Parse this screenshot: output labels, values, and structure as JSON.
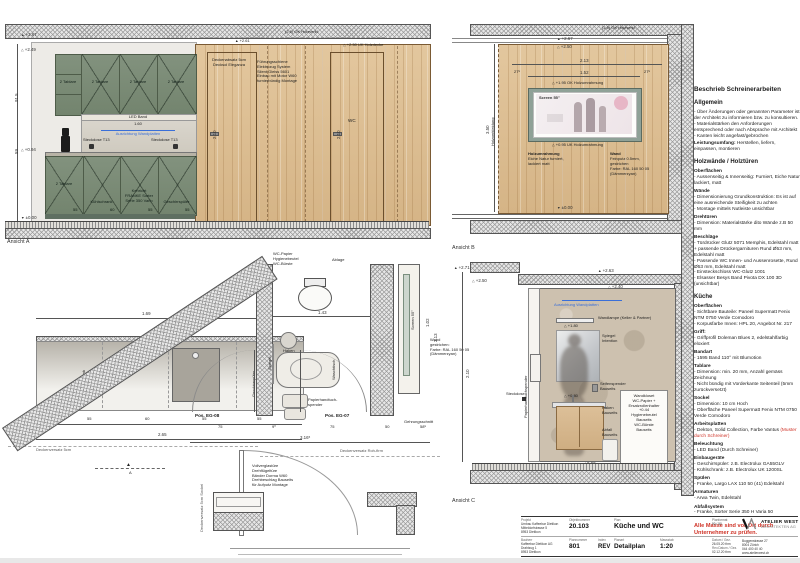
{
  "a": {
    "title": "Ansicht A",
    "lv267": "+2.67",
    "lv249": "+2.49",
    "lv094": "+0.94",
    "lv000": "±0.00",
    "d915": "91.5",
    "d59": "59",
    "d160": "1.60",
    "d210": "2.10",
    "okholz": "(2.6) OK Holzverkl.",
    "lv261": "+2.61",
    "ukholz": "+2.50 UK Holzdecke",
    "decken1": "Deckenabsatz 5cm",
    "decken2": "Decksol Eleganza",
    "doornote": [
      "Führungsschiene",
      "Elektrozug System",
      "Silent Gleiss 5601",
      "Einbau mit Motor W60",
      "furnierbündig Montage"
    ],
    "led": "LED Band",
    "ausr": "Ausrichtung Wandplatten",
    "steck": "Steckdose T13",
    "tab": "2 Tablare",
    "kuehl": "Kühlschrank",
    "keh1": "Kehricht",
    "keh2": "FRANKE Sorter",
    "keh3": "Serie 350 Vario",
    "gesch": "Geschirrspüler",
    "wc": "WC",
    "n55": "55",
    "n60": "60"
  },
  "b": {
    "title": "Ansicht B",
    "screen": "Screen 55\"",
    "lv267": "+2.67",
    "lv250": "+2.50",
    "d213": "2.13",
    "d152": "1.52",
    "d275": "27⁵",
    "okum": "+1.95 OK Holzumrahmung",
    "ukum": "+0.95 UK Holzumrahmung",
    "okholz": "(2.6) OK Holzverkl.",
    "lv000": "±0.00",
    "d350": "3.50",
    "holzverkl": "Holzverkleidung",
    "um1": "Holzumrahmung",
    "um2": "Eiche Natur furniert,",
    "um3": "lackiert matt",
    "wand1": "Wand",
    "wand2": "Feinputz 0.5mm,",
    "wand3": "gestrichen",
    "wand4": "Farbe: RAL 160 50 05",
    "wand5": "(Dämmerzyan)"
  },
  "p": {
    "d169": "1.69",
    "d265": "2.65",
    "d316": "3.16⁵",
    "d211": "2.11",
    "segs": [
      "27",
      "55",
      "60",
      "55",
      "55"
    ],
    "s75a": "75",
    "s90": "9⁰",
    "s75b": "75",
    "s50": "50",
    "s585": "58⁵",
    "kuehl": "Kühlschrank",
    "gesch": "Geschirrspüler",
    "eg08": "Pos. EG-08",
    "eg07": "Pos. EG-07",
    "wcnote": [
      "WC-Papier",
      "Hygienebeutel",
      "WC-Bürste"
    ],
    "ablage": "Ablage",
    "d143": "1.43",
    "haken": "Haken",
    "spiegel": "Spiegel",
    "wasch": "Waschtisch",
    "paph1": "Papierhandtuch-",
    "paph2": "spender",
    "glass": [
      "Vollverglastüre",
      "Drehflügeltüre",
      "Bänder Dorma W60",
      "Drehbeschlag Bauseits",
      "für Aufputz Montage"
    ],
    "deckv": "Deckenversatz 5cm",
    "deckv2": "Deckenversatz Roh-firm",
    "deckv3": "Deckenversatz 5cm Sockel",
    "secA": "A",
    "screen": "Screen 55\"",
    "d102": "1.02",
    "d213": "2.13",
    "wand": [
      "Wand",
      "gestrichen:",
      "Farbe: RAL 160 50 05",
      "(Dämmerzyan)"
    ],
    "gehrung": "Gehrungsschnitt"
  },
  "c": {
    "title": "Ansicht C",
    "lv271": "+2.71",
    "lv250": "+2.50",
    "lv263": "+2.63",
    "lv240": "+2.40",
    "lv180": "+1.80",
    "lv080": "+0.80",
    "lv000": "±0.00",
    "d210": "2.10",
    "ausr": "Ausrichtung Wandplatten",
    "lampe": "Wandlampe (Keller & Partner)",
    "spiegel1": "Spiegel",
    "spiegel2": "Intention",
    "seife1": "Seifenspender",
    "seife2": "Bauseits",
    "steck": "Steckdose",
    "haken1": "Haken",
    "haken2": "Bauseits",
    "abfall1": "Abfall",
    "abfall2": "Bauseits",
    "paph": "Papierhandtuchspender",
    "kloset": [
      "Wandkloset",
      "WC-Papier +",
      "Ersatzrollenhalter",
      "+0.44",
      "Hygienebeutel",
      "Bauseits",
      "WC-Bürste",
      "Bauseits"
    ]
  },
  "besch": {
    "title": "Beschrieb Schreinerarbeiten",
    "blocks": [
      {
        "t": "h2",
        "x": "Allgemein"
      },
      {
        "t": "p",
        "x": "- Über Änderungen oder genannten Parameter ist der Architekt zu informieren bzw. zu konsultieren."
      },
      {
        "t": "p",
        "x": "- Materialstärken den Anforderungen entsprechend oder nach Absprache mit Architekt"
      },
      {
        "t": "p",
        "x": "- Kanten leicht angefast/gebrochen"
      },
      {
        "t": "pb",
        "b": "Leistungsumfang:",
        "x": " Herstellen, liefern, einpassen, montieren"
      },
      {
        "t": "h2",
        "x": "Holzwände / Holztüren"
      },
      {
        "t": "b",
        "x": "Oberflächen"
      },
      {
        "t": "p",
        "x": "- Aussenseitig & Innenseitig: Furniert, Eiche Natur lackiert, matt"
      },
      {
        "t": "b",
        "x": "Wände"
      },
      {
        "t": "p",
        "x": "- Dimensionierung Grundkonstruktion: Es ist auf eine ausreichende Steifigkeit zu achten"
      },
      {
        "t": "p",
        "x": "- Montage mittels Nutleiste unsichtbar"
      },
      {
        "t": "b",
        "x": "Drehtüren"
      },
      {
        "t": "p",
        "x": "- Dimension: Materialstärke dito Wände z.B 50 mm"
      },
      {
        "t": "b",
        "x": "Beschläge"
      },
      {
        "t": "p",
        "x": "- Türdrücker Glutz 5071 Memphis, Edelstahl matt + passende Drückergarnituren Rund Ø53 mm, Edelstahl matt"
      },
      {
        "t": "p",
        "x": "- Passende WC Innen- und Aussenrosette, Rund Ø53 mm, Edelstahl matt"
      },
      {
        "t": "p",
        "x": "- Einsteckschloss WC-Glutz 1001"
      },
      {
        "t": "p",
        "x": "- Elsasser Besys Band Pivota DX 100 3D (unsichtbar)"
      },
      {
        "t": "h2",
        "x": "Küche"
      },
      {
        "t": "b",
        "x": "Oberflächen"
      },
      {
        "t": "p",
        "x": "- Sichtbare Bauteile: Paneel Supermatt Fenix NTM 0750 Verde Comodoro"
      },
      {
        "t": "p",
        "x": "- Korpusfarbe Innen: HPL 20, Angebot Nr. 217"
      },
      {
        "t": "b",
        "x": "Griff:"
      },
      {
        "t": "p",
        "x": "- Griffprofil Doleman Blues 2, edelstahlfarbig eloxiert"
      },
      {
        "t": "b",
        "x": "Bandart"
      },
      {
        "t": "p",
        "x": "- 1595 Band 110° mit Blumotion"
      },
      {
        "t": "b",
        "x": "Tablare"
      },
      {
        "t": "p",
        "x": "- Dimension: min. 20 mm, Anzahl gemäss Zeichnung"
      },
      {
        "t": "p",
        "x": "- Nicht bündig mit Vorderkante Seitenteil (5mm zurückversetzt)"
      },
      {
        "t": "b",
        "x": "Sockel"
      },
      {
        "t": "p",
        "x": "- Dimension: 10 cm Hoch"
      },
      {
        "t": "p",
        "x": "- Oberfläche Paneel Supermatt Fenix NTM 0750 Verde Comodoro"
      },
      {
        "t": "b",
        "x": "Arbeitsplatten"
      },
      {
        "t": "pr",
        "b": "- Dekton, Solid Collection, Farbe Vantus ",
        "x": "(Muster durch Schreiner)"
      },
      {
        "t": "b",
        "x": "Beleuchtung"
      },
      {
        "t": "p",
        "x": "- LED Band (Durch Schreiner)"
      },
      {
        "t": "b",
        "x": "Einbaugeräte"
      },
      {
        "t": "p",
        "x": "- Geschirrspüler: z.B. Electrolux GA55GLV"
      },
      {
        "t": "p",
        "x": "- Kühlschrank: z.B. Electrolux UK 1200SL"
      },
      {
        "t": "b",
        "x": "Spülen"
      },
      {
        "t": "p",
        "x": "- Franke, Largo LAX 110 50 (41) Edelstahl"
      },
      {
        "t": "b",
        "x": "Armaturen"
      },
      {
        "t": "p",
        "x": "- Arwa Twin, Edelstahl"
      },
      {
        "t": "b",
        "x": "Abfallsystem"
      },
      {
        "t": "p",
        "x": "- Franke, Sorter Serie 350 H Varia 50"
      },
      {
        "t": "red",
        "x": "Alle Masse sind vor Ort durch Unternehmer zu prüfen."
      }
    ]
  },
  "tb": {
    "projekt_label": "Projekt",
    "projekt": [
      "Umbau Kaffeebar Dietikon",
      "Mitteldorfstrasse 5",
      "8953 Dietikon"
    ],
    "bauherr_label": "Bauherr",
    "bauherr": [
      "Kaffeebar Dietikon AG",
      "Drahtzug 1",
      "8953 Dietikon"
    ],
    "objnr_label": "Objektnummer",
    "objnr": "20.103",
    "plan_label": "Plan",
    "plan": "Küche und WC",
    "plannr_label": "Plannummer",
    "plannr": "801",
    "index_label": "Index",
    "index": "REV",
    "planart_label": "Planart",
    "planart": "Detailplan",
    "massstab_label": "Massstab",
    "massstab": "1:20",
    "format_label": "Planformat",
    "format": "90 / 50",
    "datum_label": "Datum / Gez.",
    "datum": "26.05.20  thm",
    "rev_label": "Rev.Datum / Gez.",
    "rev": "02.12.20  thm",
    "firm1": "ATELIER WEST",
    "firm2": "ARCHITEKTEN AG",
    "addr": [
      "Buggenstrasse 27",
      "8004 Zürich",
      "044 400 40 40",
      "www.atelierwest.ch"
    ]
  }
}
